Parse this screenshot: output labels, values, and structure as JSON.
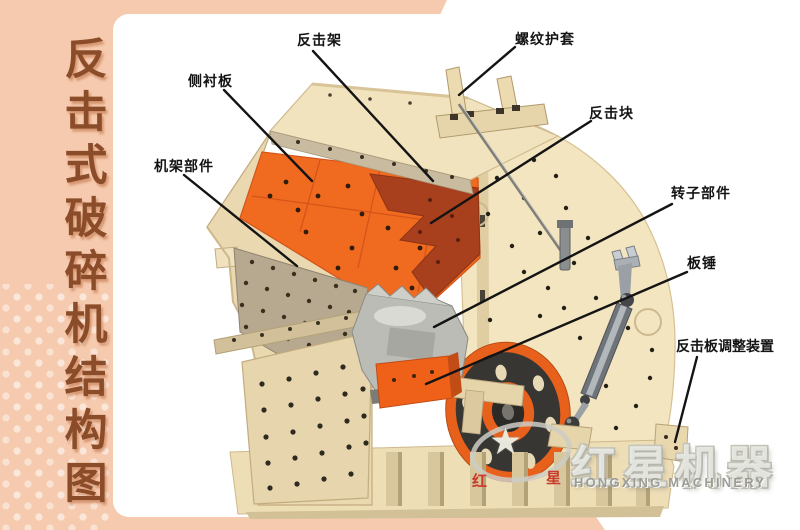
{
  "sidebar": {
    "title": "反击式破碎机结构图"
  },
  "diagram": {
    "labels": [
      {
        "id": "impact-frame",
        "text": "反击架"
      },
      {
        "id": "threaded-sleeve",
        "text": "螺纹护套"
      },
      {
        "id": "side-liner-plate",
        "text": "侧衬板"
      },
      {
        "id": "impact-block",
        "text": "反击块"
      },
      {
        "id": "frame-parts",
        "text": "机架部件"
      },
      {
        "id": "rotor-parts",
        "text": "转子部件"
      },
      {
        "id": "blow-bar",
        "text": "板锤"
      },
      {
        "id": "impact-plate-adjuster",
        "text": "反击板调整装置"
      }
    ]
  },
  "watermark": {
    "brand_cn": "红星机器",
    "brand_en": "HONGXING MACHINERY",
    "logo_char_left": "红",
    "logo_char_right": "星",
    "star_glyph": "★"
  },
  "colors": {
    "frame_pink": "#f6caae",
    "title_brown": "#8b4c2a",
    "machine_beige": "#f2e4bd",
    "machine_orange": "#f06a1f",
    "impact_plate_rust": "#a8401d",
    "flywheel_rim_orange": "#e8611c",
    "steel_gray": "#8f959b"
  }
}
